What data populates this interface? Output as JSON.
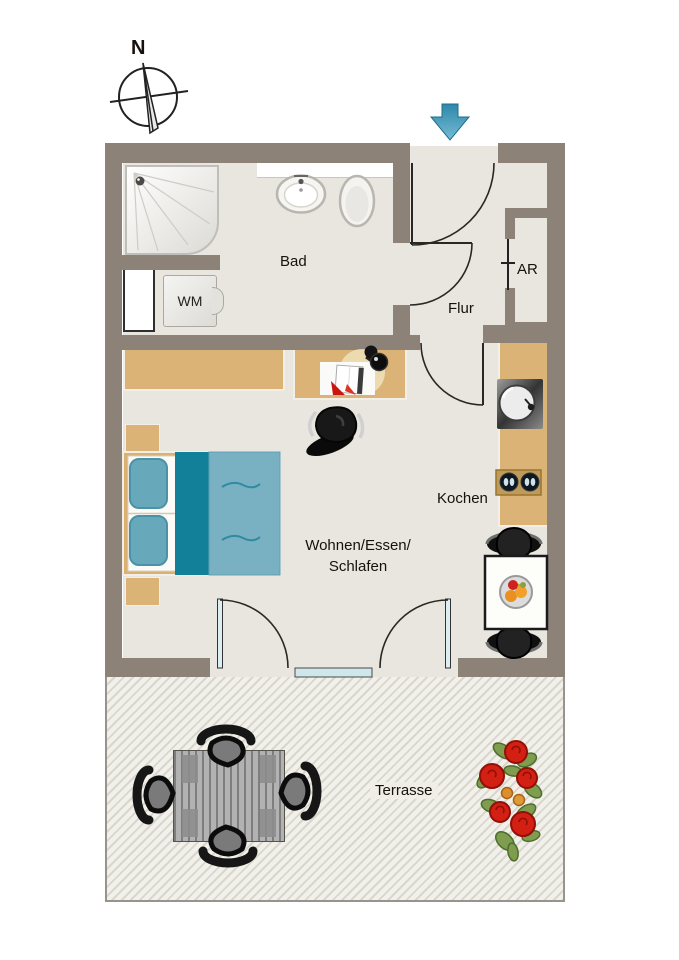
{
  "compass": {
    "north_label": "N"
  },
  "rooms": {
    "bad": {
      "label": "Bad"
    },
    "flur": {
      "label": "Flur"
    },
    "abstellraum": {
      "label": "AR"
    },
    "kochen": {
      "label": "Kochen"
    },
    "wohnen": {
      "label_line1": "Wohnen/Essen/",
      "label_line2": "Schlafen"
    },
    "terrasse": {
      "label": "Terrasse"
    }
  },
  "appliances": {
    "washing_machine_label": "WM"
  },
  "icons": {
    "compass_icon": "compass-rose",
    "entrance_arrow_icon": "down-arrow"
  },
  "palette": {
    "wall": "#8c8278",
    "floor": "#e9e6df",
    "wood": "#dcb377",
    "bed_blanket": "#128099",
    "bed_duvet": "#7ab1c2",
    "pillow": "#67a9bb",
    "door_glass": "#cfe7ea",
    "flower_red": "#d32013",
    "leaf_green": "#7e9d4f",
    "arrow_top": "#2f87a8",
    "arrow_bottom": "#74bcd6"
  }
}
